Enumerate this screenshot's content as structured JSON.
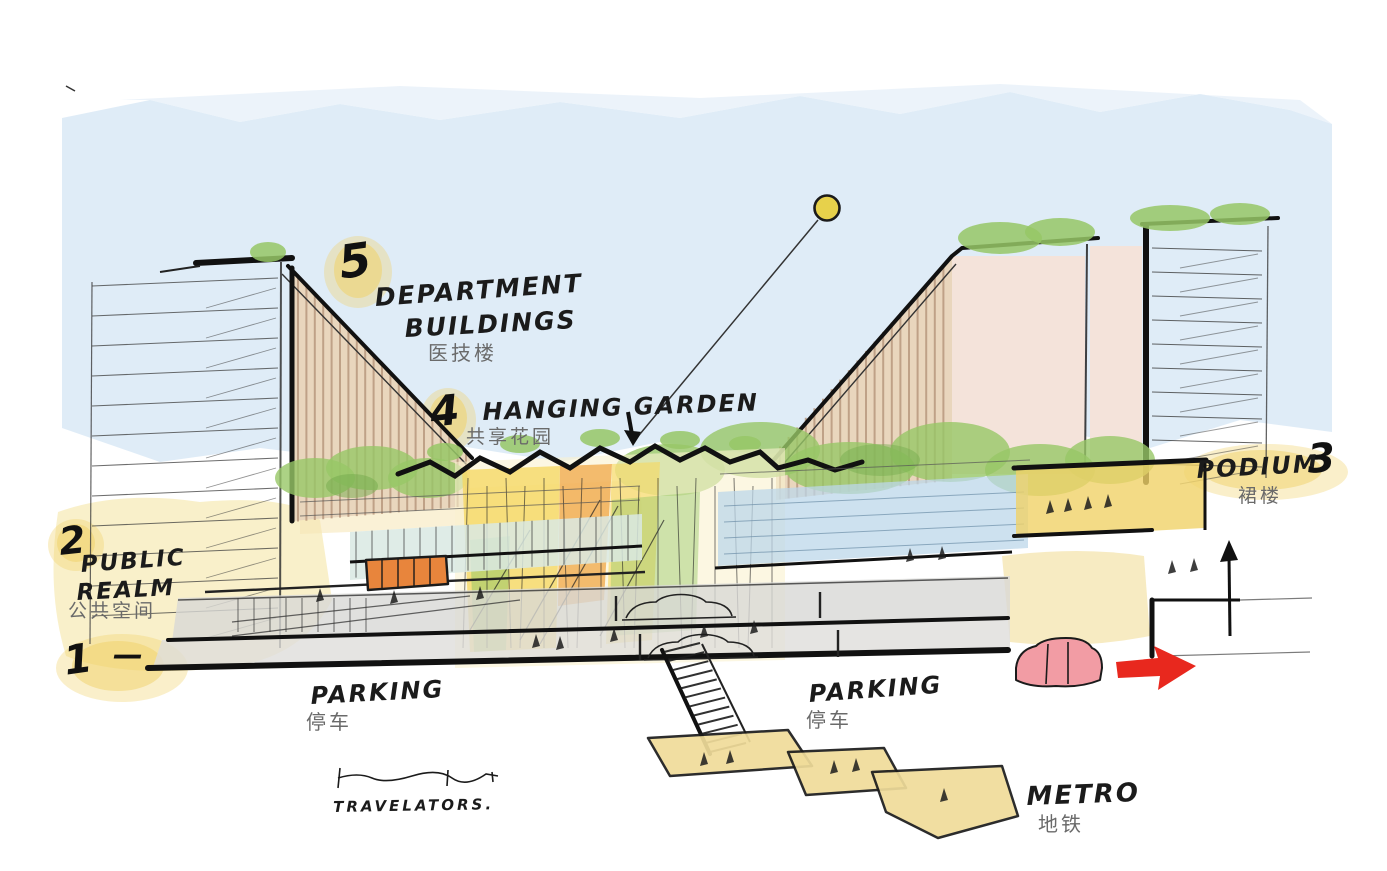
{
  "annotations": {
    "department_buildings": {
      "number": "5",
      "label_line1": "DEPARTMENT",
      "label_line2": "BUILDINGS",
      "label_zh": "医技楼"
    },
    "hanging_garden": {
      "number": "4",
      "label": "HANGING GARDEN",
      "label_zh": "共享花园"
    },
    "podium": {
      "number": "3",
      "label": "PODIUM",
      "label_zh": "裙楼"
    },
    "public_realm": {
      "number": "2",
      "label_line1": "PUBLIC",
      "label_line2": "REALM",
      "label_zh": "公共空间"
    },
    "level_one": {
      "number": "1",
      "dash": "—"
    },
    "parking_left": {
      "label": "PARKING",
      "label_zh": "停车"
    },
    "parking_right": {
      "label": "PARKING",
      "label_zh": "停车"
    },
    "metro": {
      "label": "METRO",
      "label_zh": "地铁"
    },
    "travelators": {
      "label": "TRAVELATORS."
    }
  },
  "colors": {
    "sky": "#d9e9f6",
    "highlight": "#f0d268",
    "ink": "#1b1b1b",
    "facade_tan": "#e9d6bd",
    "facade_stripe": "#b5947a",
    "pink_facade": "#f4e3da",
    "green": "#97c766",
    "green_dark": "#74aa4b",
    "atrium_yellow": "#f6d75e",
    "atrium_orange": "#f0a13c",
    "water_blue": "#bcd7ea",
    "glazing_teal": "#d9e9e3",
    "parking_gray": "#d8d8d6",
    "platform_yellow": "#f0dc9a",
    "wash_yellow": "#f6e8ae",
    "arrow_red": "#e8281e",
    "car_pink": "#f29ca4",
    "bus_orange": "#e8853c",
    "balloon_yellow": "#e7d14b"
  }
}
